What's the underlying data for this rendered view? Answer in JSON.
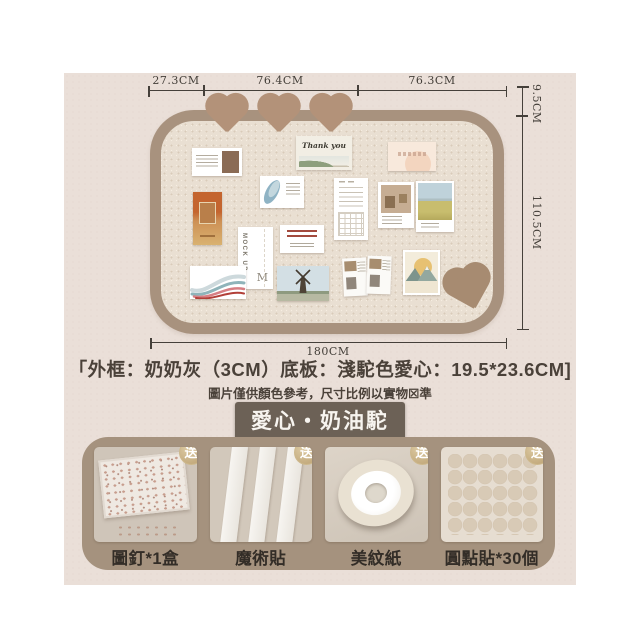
{
  "poster": {
    "dimensions": {
      "top": [
        "27.3CM",
        "76.4CM",
        "76.3CM"
      ],
      "right_upper": "9.5CM",
      "right_lower": "110.5CM",
      "bottom": "180CM"
    },
    "spec_line": "「外框：奶奶灰（3CM）底板：淺駝色愛心：19.5*23.6CM]",
    "disclaimer": "圖片僅供顏色參考，尺寸比例以實物☒準",
    "title_badge": "愛心・奶油駝",
    "colors": {
      "canvas_bg": "#ffffff",
      "poster_bg": "#eadfd8",
      "board_frame": "#a8927e",
      "board_surface": "#e9dfd2",
      "top_hearts": "#b39279",
      "corner_heart": "#a78b71",
      "badge_bg": "#6c6156",
      "panel_bg": "#a5927e",
      "gift_badge_gold": "#c4ab7d"
    },
    "board_cards": {
      "thank_you_text": "Thank you",
      "mockup_text": "MOCK UP",
      "mockup_initial": "M"
    },
    "gifts": {
      "badge_label": "送",
      "items": [
        {
          "name": "push-pins",
          "label": "圖釘*1盒"
        },
        {
          "name": "velcro-strips",
          "label": "魔術貼"
        },
        {
          "name": "masking-tape",
          "label": "美紋紙"
        },
        {
          "name": "dot-stickers",
          "label": "圓點貼*30個"
        }
      ]
    }
  }
}
